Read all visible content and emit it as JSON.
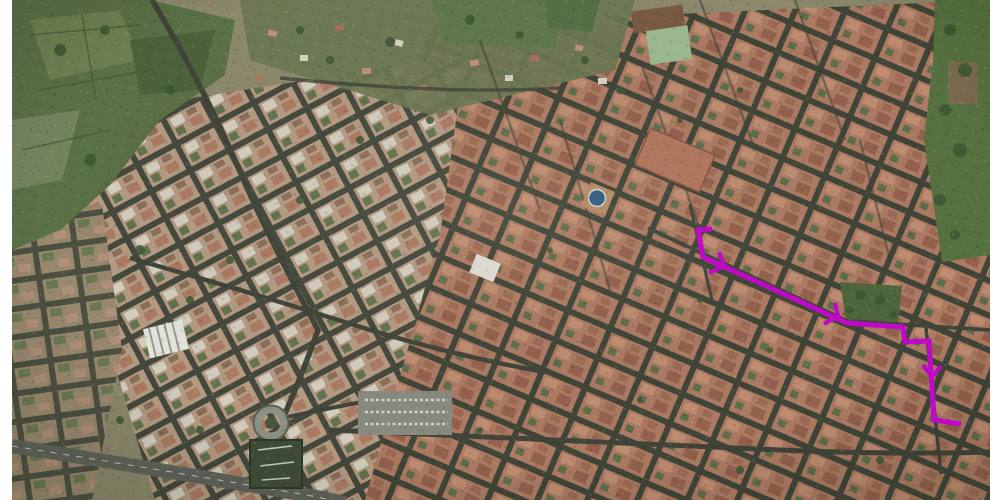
{
  "scene": {
    "type": "satellite-aerial-photo",
    "description": "Aerial satellite view of a dense historic town (terracotta rooftops, dark narrow streets, green fields upper-left, park strip on right edge, highway lower-left) with a magenta route annotation drawn over the old town on the right side",
    "background_color": "#ffffff",
    "photo_area": {
      "left": 12,
      "top": 0,
      "right": 990,
      "bottom": 500
    }
  },
  "palette": {
    "rooftops": "#b07b63",
    "rooftop_light": "#d3c9b6",
    "streets": "#3f4336",
    "vegetation": "#5a7044",
    "highway": "#60635a",
    "plaza_dome": "#2c5c80",
    "route": "#c008c8"
  },
  "route": {
    "color": "#c008c8",
    "stroke_width": 5,
    "arrow_stroke_width": 4.2,
    "points": [
      [
        712,
        229
      ],
      [
        698,
        230
      ],
      [
        703,
        257
      ],
      [
        847,
        323
      ],
      [
        903,
        327
      ],
      [
        905,
        342
      ],
      [
        929,
        341
      ],
      [
        934,
        420
      ],
      [
        961,
        424
      ]
    ],
    "arrowheads": [
      {
        "points": [
          [
            719,
            252
          ],
          [
            724,
            266
          ],
          [
            709,
            273
          ]
        ]
      },
      {
        "points": [
          [
            835,
            303
          ],
          [
            838,
            316
          ],
          [
            824,
            324
          ]
        ]
      },
      {
        "points": [
          [
            923,
            365
          ],
          [
            932,
            377
          ],
          [
            941,
            366
          ]
        ]
      }
    ]
  }
}
